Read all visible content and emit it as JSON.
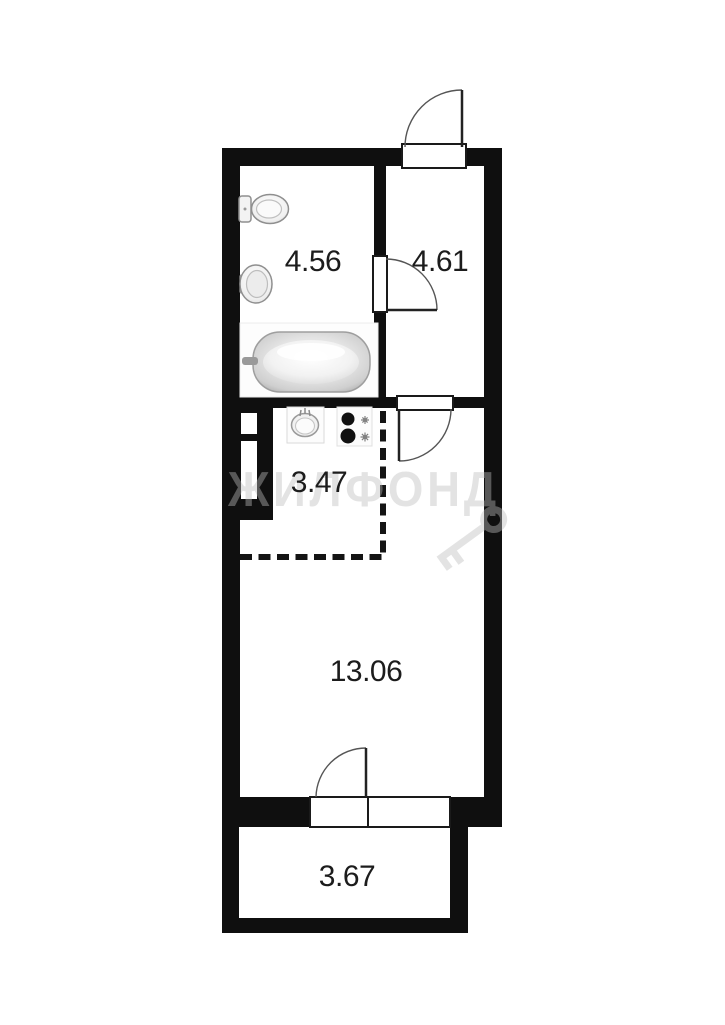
{
  "plan": {
    "name": "studio-apartment-floor-plan",
    "wall_color": "#0f0f0f",
    "label_color": "#1c1c1c",
    "dashed_zone_color": "#141414",
    "rooms": [
      {
        "name": "bathroom",
        "area": "4.56"
      },
      {
        "name": "hallway",
        "area": "4.61"
      },
      {
        "name": "kitchen",
        "area": "3.47"
      },
      {
        "name": "living-room",
        "area": "13.06"
      },
      {
        "name": "balcony",
        "area": "3.67"
      }
    ],
    "watermark": {
      "text": "ЖИЛФОНД",
      "color": "#bebebe"
    },
    "fixtures": [
      "toilet-icon",
      "bathroom-sink-icon",
      "bathtub-icon",
      "kitchen-sink-icon",
      "stove-icon",
      "vent-shaft-icon",
      "key-watermark-icon"
    ],
    "doors": [
      "entrance-door",
      "bathroom-door",
      "hallway-living-door",
      "balcony-door"
    ],
    "windows": [
      "balcony-window"
    ]
  }
}
